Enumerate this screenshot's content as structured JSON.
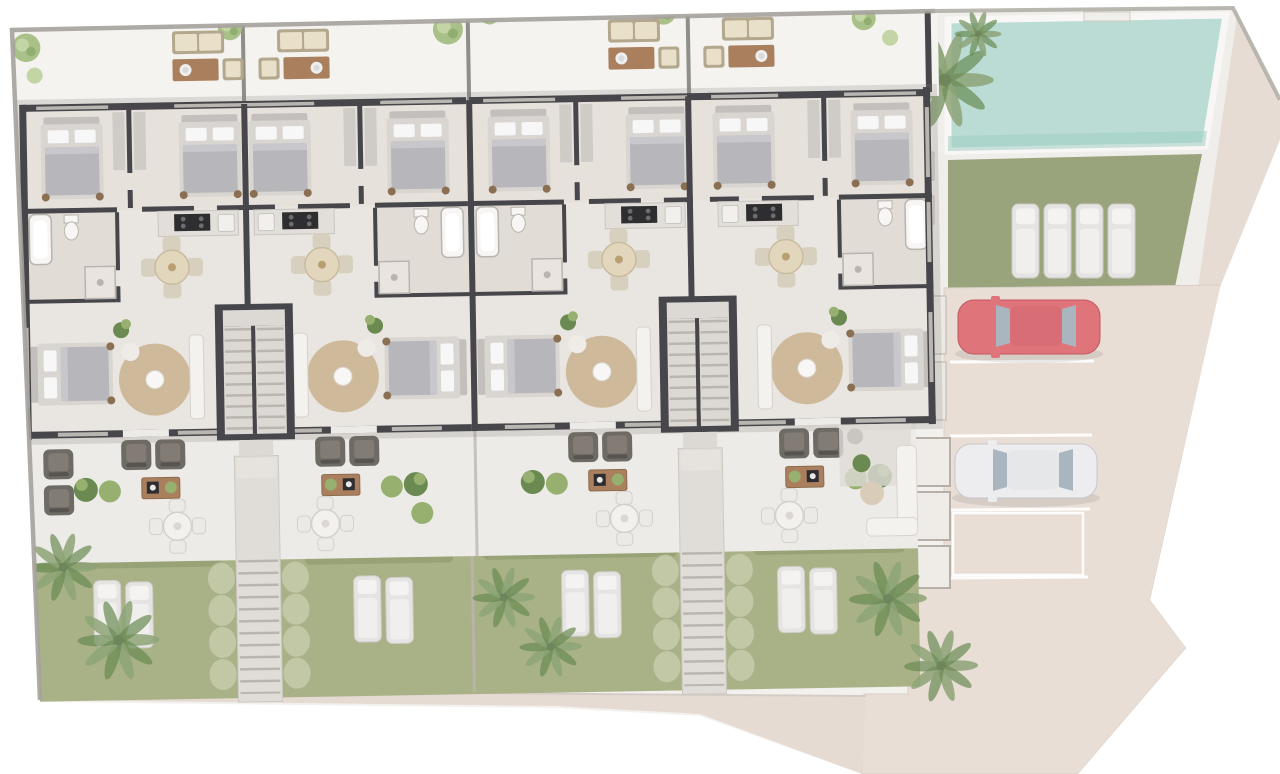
{
  "scene": {
    "description": "Aerial rendered site plan: four attached single-storey homes with rear patios, front terraces and private gardens, shared swimming pool with sun deck, lawn with loungers, and a private parking court with two cars",
    "residential_units": 4,
    "shared_stair_cores": 2,
    "front_stair_paths": 2
  },
  "per_unit": {
    "top_bedrooms": 2,
    "lower_bedrooms": 1,
    "bathrooms": 1,
    "dining_chairs": 4,
    "terrace_armchairs": 2,
    "rear_patio_lounge_sets": 1,
    "bbq_station": true,
    "outdoor_dining_set": true
  },
  "pool_area": {
    "pools": 1,
    "sun_loungers": 4,
    "pool_ladder": 1,
    "palm_trees": 2
  },
  "gardens": {
    "count": 4,
    "loungers_per_garden": 2,
    "hedge_columns": 4,
    "palm_clusters": 6
  },
  "parking": {
    "stalls": 4,
    "cars": [
      {
        "name": "red-car",
        "body_color": "#df747b"
      },
      {
        "name": "white-car",
        "body_color": "#ededef"
      }
    ]
  },
  "colors": {
    "wall": "#47474b",
    "wall-light": "#7d7b76",
    "floor": "#e9e5e1",
    "floor-bed": "#e5dfd9",
    "bath-floor": "#ded5cf",
    "patio": "#f4f3f0",
    "terrace": "#edebe7",
    "deck": "#f0eeea",
    "pool": "#badcd4",
    "pool-deep": "#9ecdc3",
    "stone": "#e6dcd4",
    "pave": "#e8ded6",
    "sidewalk": "#e5dbd3",
    "lawn": "#9aa47c",
    "lawn-light": "#a9b287",
    "hedge": "#c2c8a6",
    "hedge-dark": "#94a073",
    "line-white": "#ffffff",
    "car-red": "#df747b",
    "car-red-roof": "#d96d75",
    "car-white": "#ededef",
    "car-white-roof": "#e6e7e9",
    "car-window": "#aab6bf",
    "bed-frame": "#d9d5d1",
    "bed-head": "#c2bfbc",
    "bed-cover": "#b7b6ba",
    "bed-fold": "#c8c7cb",
    "pillow": "#f7f7f8",
    "knob": "#8a6f52",
    "sofa-dark": "#6e6a64",
    "sofa-dark-cushion": "#827c75",
    "sofa-light": "#f4f2ef",
    "wood": "#a97f5e",
    "chair-beige": "#d8d0bf",
    "table-beige": "#e2d7bd",
    "rug": "#ccb797",
    "plant": "#6a8a52",
    "plant-light": "#97b06f",
    "palm": "#8da377",
    "tree": "#a9c188",
    "tree-light": "#c3d5a5",
    "stair": "#dcd8d4",
    "stair-line": "#bab5af",
    "counter": "#e2deda",
    "counter-edge": "#c9c5c0",
    "black": "#2e2e30",
    "window": "#b9b6b2",
    "fixture": "#f7f6f4",
    "fixture-edge": "#b9b4ae",
    "pad": "#efece8",
    "pad-edge": "#b5afa8",
    "boundary": "#a5a19c",
    "shadow": "#85817c",
    "pouf": "#d9cdb9",
    "divider": "#c6c1bb",
    "path-fill": "#e0dcd7"
  }
}
